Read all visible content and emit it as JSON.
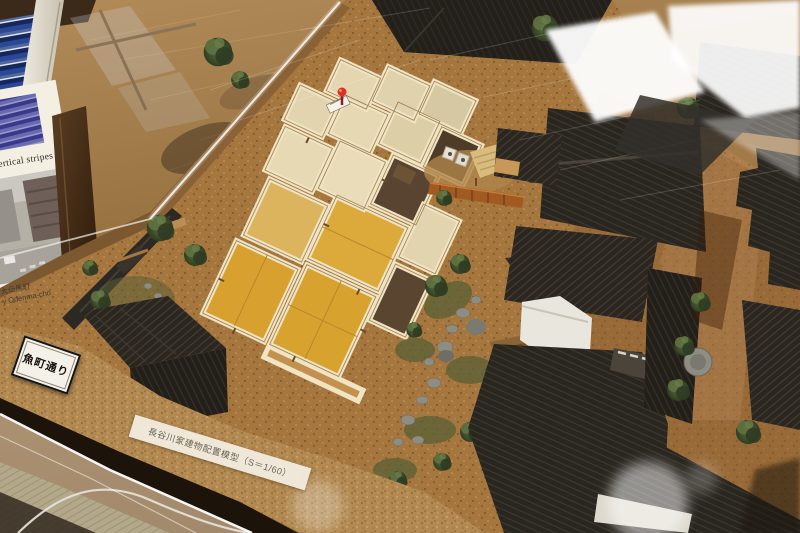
{
  "labels": {
    "street_plaque": "魚町通り",
    "model_caption": "長谷川家建物配置模型（S＝1/60）"
  },
  "poster": {
    "title": "vertical stripes",
    "caption_jp": "大伝馬町",
    "caption_en": "y Odenma-cho"
  },
  "colors": {
    "table_wood": "#9b7648",
    "model_ground": "#a5773f",
    "roof_tile": "#282420",
    "model_tatami": "#d8a22f",
    "model_wall": "#f0e4c2",
    "room_floor_tatami": "#b4a98b",
    "greenery": "#42522e",
    "textile_blue": "#2a4896",
    "kura_wall": "#e9e6de",
    "pushpin_red": "#e03020"
  }
}
